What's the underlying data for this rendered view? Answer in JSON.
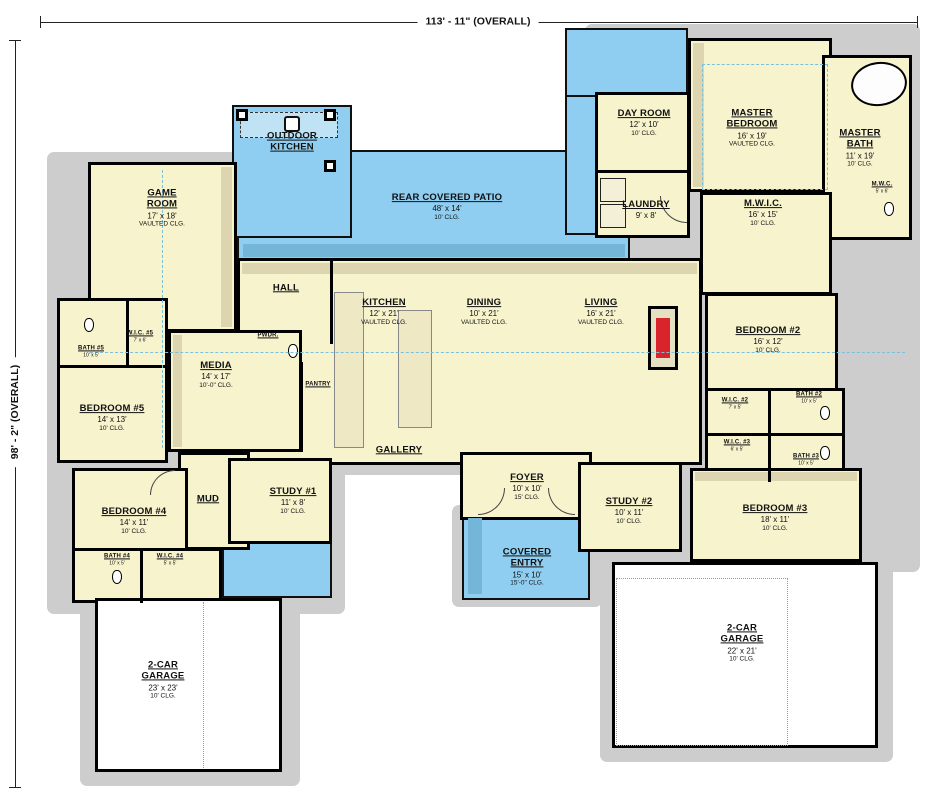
{
  "plan": {
    "type": "single-story house floor plan",
    "top_dimension": "113' - 11\" (OVERALL)",
    "left_dimension": "98' - 2\" (OVERALL)"
  },
  "colors": {
    "room_fill": "#f7f3cd",
    "outdoor_fill": "#8fcef0",
    "wall": "#000000",
    "shadow": "#cdcdcd",
    "fireplace_accent": "#d8242a",
    "vault_dash": "#79c0dc"
  },
  "rooms": {
    "outdoor_kitchen": {
      "name": "OUTDOOR KITCHEN"
    },
    "rear_covered_patio": {
      "name": "REAR COVERED PATIO",
      "dims": "48' x 14'",
      "clg": "10' CLG."
    },
    "day_room": {
      "name": "DAY ROOM",
      "dims": "12' x 10'",
      "clg": "10' CLG."
    },
    "master_bedroom": {
      "name": "MASTER BEDROOM",
      "dims": "16' x 19'",
      "clg": "VAULTED CLG."
    },
    "master_bath": {
      "name": "MASTER BATH",
      "dims": "11' x 19'",
      "clg": "10' CLG."
    },
    "mwc": {
      "name": "M.W.C.",
      "dims": "5' x 6'"
    },
    "game_room": {
      "name": "GAME ROOM",
      "dims": "17' x 18'",
      "clg": "VAULTED CLG."
    },
    "laundry": {
      "name": "LAUNDRY",
      "dims": "9' x 8'"
    },
    "mwic": {
      "name": "M.W.I.C.",
      "dims": "16' x 15'",
      "clg": "10' CLG."
    },
    "hall": {
      "name": "HALL"
    },
    "kitchen": {
      "name": "KITCHEN",
      "dims": "12' x 21'",
      "clg": "VAULTED CLG."
    },
    "dining": {
      "name": "DINING",
      "dims": "10' x 21'",
      "clg": "VAULTED CLG."
    },
    "living": {
      "name": "LIVING",
      "dims": "16' x 21'",
      "clg": "VAULTED CLG."
    },
    "bedroom_2": {
      "name": "BEDROOM #2",
      "dims": "16' x 12'",
      "clg": "10' CLG."
    },
    "media": {
      "name": "MEDIA",
      "dims": "14' x 17'",
      "clg": "10'-0\" CLG."
    },
    "pantry": {
      "name": "PANTRY"
    },
    "pwdr": {
      "name": "PWDR."
    },
    "bath_5": {
      "name": "BATH #5",
      "dims": "10' x 5'"
    },
    "wic_5": {
      "name": "W.I.C. #5",
      "dims": "7' x 6'"
    },
    "bedroom_5": {
      "name": "BEDROOM #5",
      "dims": "14' x 13'",
      "clg": "10' CLG."
    },
    "wic_2": {
      "name": "W.I.C. #2",
      "dims": "7' x 5'"
    },
    "bath_2": {
      "name": "BATH #2",
      "dims": "10' x 5'"
    },
    "wic_3": {
      "name": "W.I.C. #3",
      "dims": "6' x 5'"
    },
    "bath_3": {
      "name": "BATH #3",
      "dims": "10' x 5'"
    },
    "gallery": {
      "name": "GALLERY"
    },
    "bedroom_4": {
      "name": "BEDROOM #4",
      "dims": "14' x 11'",
      "clg": "10' CLG."
    },
    "mud": {
      "name": "MUD"
    },
    "study_1": {
      "name": "STUDY #1",
      "dims": "11' x 8'",
      "clg": "10' CLG."
    },
    "foyer": {
      "name": "FOYER",
      "dims": "10' x 10'",
      "clg": "15' CLG."
    },
    "study_2": {
      "name": "STUDY #2",
      "dims": "10' x 11'",
      "clg": "10' CLG."
    },
    "bedroom_3": {
      "name": "BEDROOM #3",
      "dims": "18' x 11'",
      "clg": "10' CLG."
    },
    "covered_entry": {
      "name": "COVERED ENTRY",
      "dims": "15' x 10'",
      "clg": "15'-0\" CLG."
    },
    "bath_4": {
      "name": "BATH #4",
      "dims": "10' x 5'"
    },
    "wic_4": {
      "name": "W.I.C. #4",
      "dims": "5' x 5'"
    },
    "garage_left": {
      "name": "2-CAR GARAGE",
      "dims": "23' x 23'",
      "clg": "10' CLG."
    },
    "garage_right": {
      "name": "2-CAR GARAGE",
      "dims": "22' x 21'",
      "clg": "10' CLG."
    }
  }
}
